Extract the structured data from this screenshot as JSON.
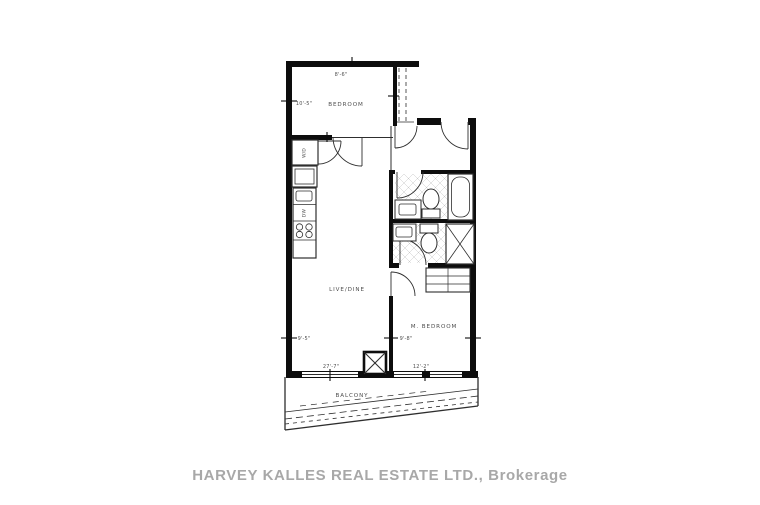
{
  "watermark": "HARVEY KALLES REAL ESTATE LTD., Brokerage",
  "rooms": {
    "bedroom": {
      "label": "BEDROOM",
      "width": "8'-6\"",
      "depth": "10'-5\""
    },
    "live_dine": {
      "label": "LIVE/DINE",
      "width": "27'-7\"",
      "depth": "9'-5\""
    },
    "m_bedroom": {
      "label": "M. BEDROOM",
      "width": "12'-2\"",
      "depth": "9'-8\""
    },
    "balcony": {
      "label": "BALCONY"
    }
  },
  "fixtures": {
    "washer_dryer": "W/D",
    "dishwasher": "DW"
  },
  "colors": {
    "wall": "#0d0d0d",
    "line": "#2e2e2e",
    "label": "#4f4f4f",
    "tile": "#c9c9c9",
    "watermark": "#a8a8a8",
    "background": "#ffffff"
  }
}
